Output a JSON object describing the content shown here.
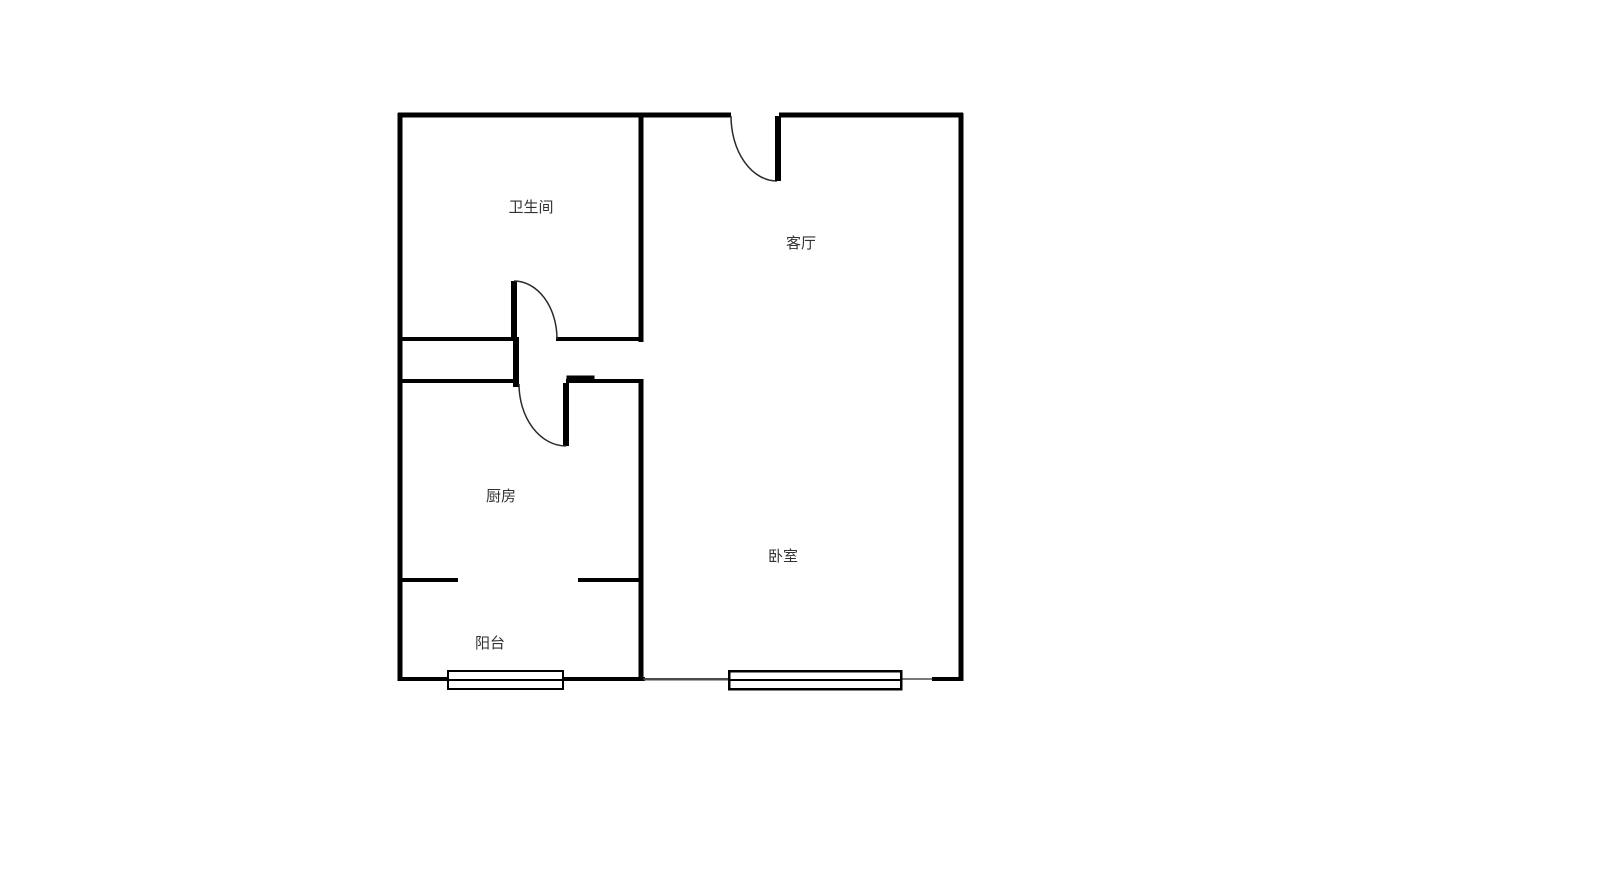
{
  "floorplan": {
    "title": "one-bedroom apartment floor plan",
    "rooms": {
      "bathroom": {
        "label": "卫生间"
      },
      "living_room": {
        "label": "客厅"
      },
      "kitchen": {
        "label": "厨房"
      },
      "bedroom": {
        "label": "卧室"
      },
      "balcony": {
        "label": "阳台"
      }
    },
    "symbols": {
      "doors": [
        "entry-door",
        "bathroom-door",
        "kitchen-door"
      ],
      "windows": [
        "balcony-window",
        "bedroom-window"
      ]
    },
    "colors": {
      "wall": "#000000",
      "text": "#333333",
      "background": "#ffffff",
      "thin_wall": "#555555"
    }
  }
}
